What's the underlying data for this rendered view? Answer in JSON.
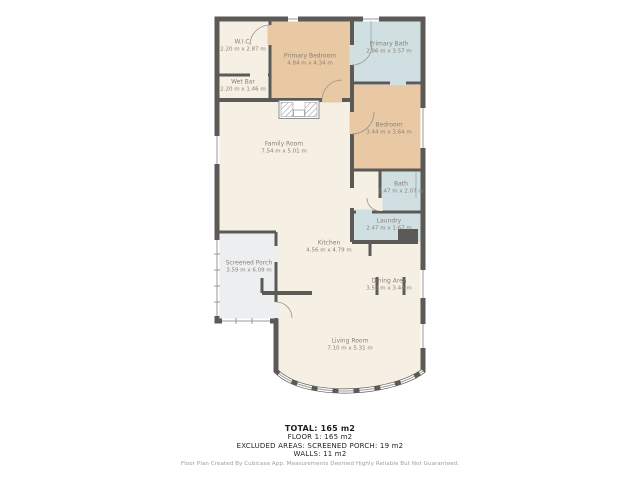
{
  "plan": {
    "rooms": [
      {
        "name": "W.I.C.",
        "dims": "2.20 m x 2.87 m"
      },
      {
        "name": "Primary Bedroom",
        "dims": "4.84 m x 4.34 m"
      },
      {
        "name": "Primary Bath",
        "dims": "2.86 m x 3.57 m"
      },
      {
        "name": "Wet Bar",
        "dims": "2.20 m x 1.46 m"
      },
      {
        "name": "Family Room",
        "dims": "7.54 m x 5.01 m"
      },
      {
        "name": "Bedroom",
        "dims": "3.44 m x 3.64 m"
      },
      {
        "name": "Bath",
        "dims": "2.47 m x 2.07 m"
      },
      {
        "name": "Laundry",
        "dims": "2.47 m x 1.67 m"
      },
      {
        "name": "Kitchen",
        "dims": "4.56 m x 4.79 m"
      },
      {
        "name": "Screened Porch",
        "dims": "3.59 m x 6.09 m"
      },
      {
        "name": "Dining Area",
        "dims": "3.52 m x 3.44 m"
      },
      {
        "name": "Living Room",
        "dims": "7.10 m x 5.31 m"
      }
    ],
    "colors": {
      "wall": "#5c5a57",
      "floor": "#f5efe4",
      "bedroom_fill": "#e9c8a4",
      "bath_fill": "#cfdfe2",
      "porch_fill": "#eceeef"
    }
  },
  "summary": {
    "total": "TOTAL: 165 m2",
    "floor1": "FLOOR 1: 165 m2",
    "excluded": "EXCLUDED AREAS: SCREENED PORCH: 19 m2",
    "walls": "WALLS: 11 m2"
  },
  "footer": {
    "disclaimer": "Floor Plan Created By Cubicasa App. Measurements Deemed Highly Reliable But Not Guaranteed."
  }
}
